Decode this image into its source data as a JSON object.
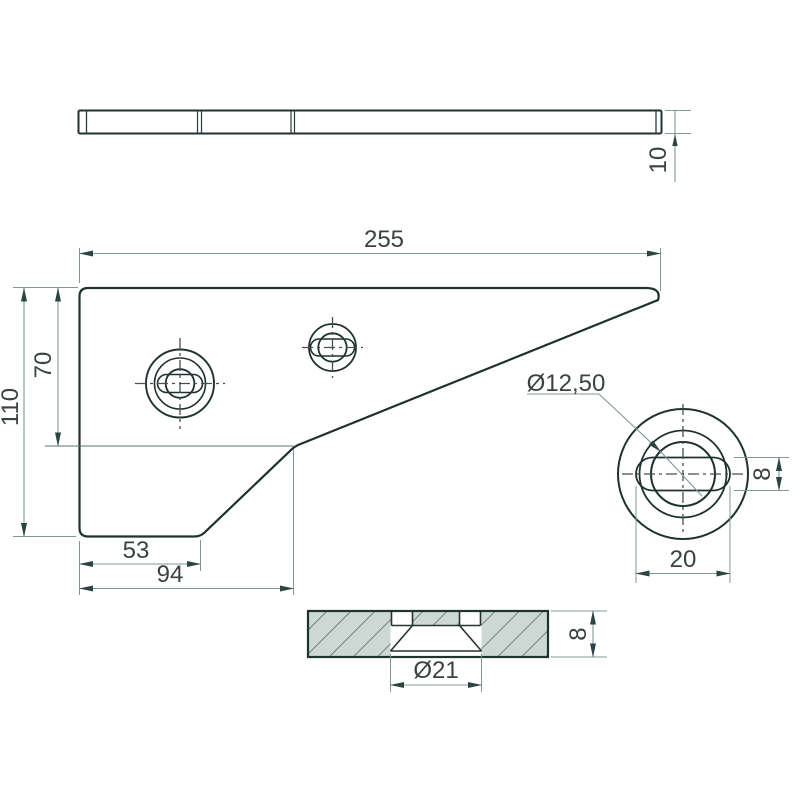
{
  "drawing": {
    "description": "2D CAD technical drawing of a flat counter knife plate with slotted countersunk holes, three orthographic views plus hole detail view",
    "front_view": {
      "width": "255",
      "height": "110",
      "upper_height": "70",
      "foot_width": "53",
      "notch_width": "94"
    },
    "top_view": {
      "thickness": "10"
    },
    "detail_view": {
      "bore_diameter": "Ø12,50",
      "slot_height": "8",
      "slot_width": "20"
    },
    "section_view": {
      "countersink_diameter": "Ø21",
      "thickness": "8"
    },
    "colors": {
      "background": "#ffffff",
      "part_fill": "#8aa7a4",
      "counterbore_fill": "#c2d1ce",
      "section_fill": "#cdd8d5",
      "outline": "#1e3230",
      "dimension_line": "#7d9996",
      "arrow": "#2c4543",
      "centerline": "#45504f",
      "text": "#3a4242"
    }
  }
}
